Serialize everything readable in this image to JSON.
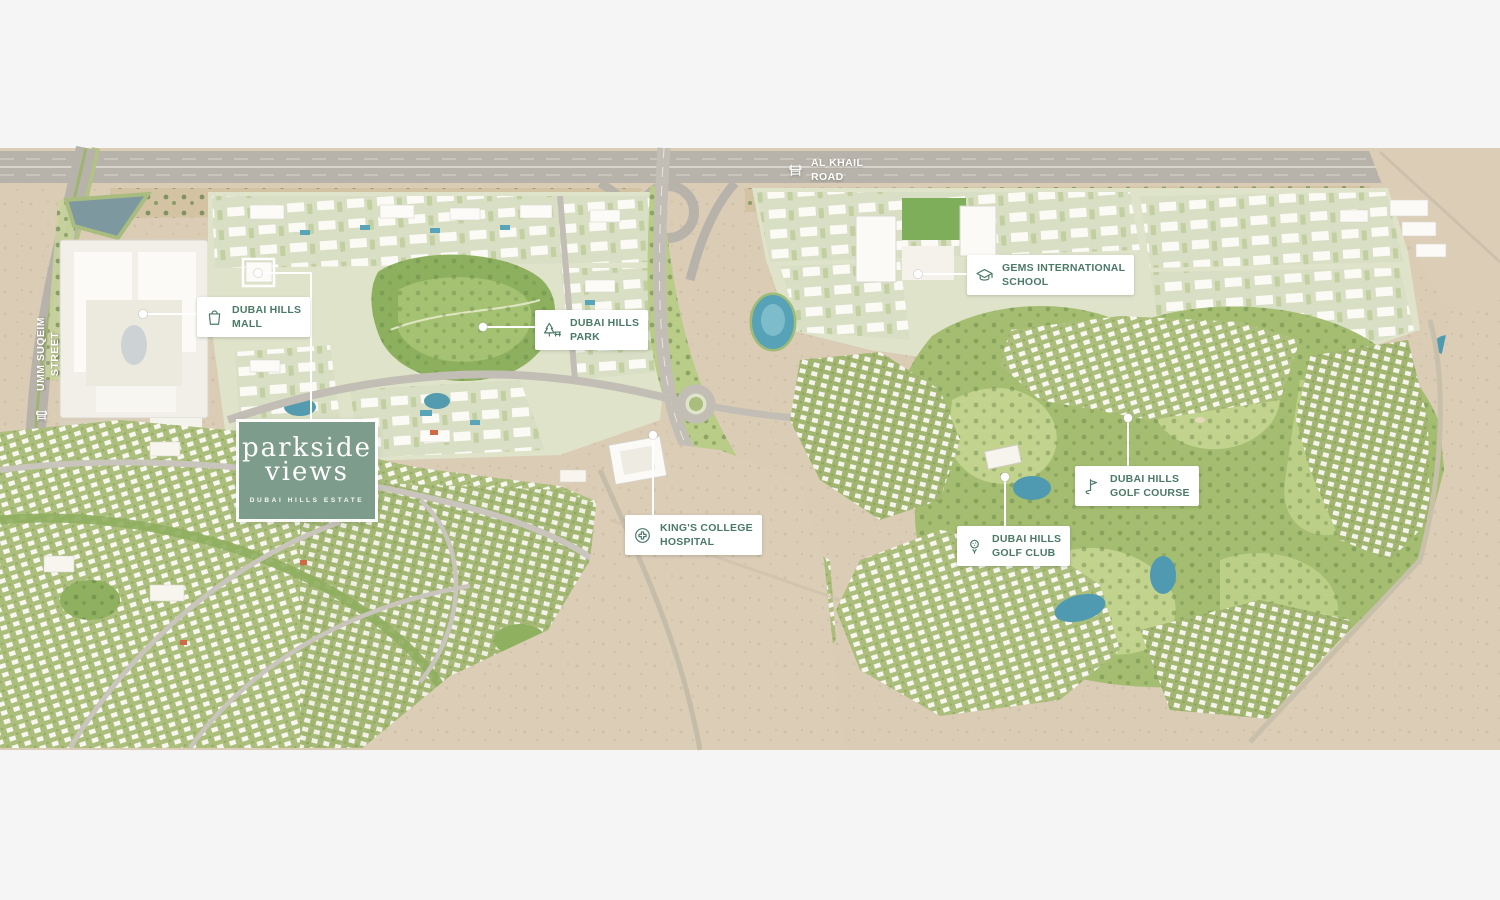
{
  "colors": {
    "page_bg": "#f4f5f4",
    "label_text": "#4c7a67",
    "label_bg": "#ffffff",
    "card_bg": "#7d9c8c",
    "desert": "#daccb5",
    "road": "#b7b3aa",
    "greenery": "#a9bd7d",
    "golf_green": "#a4bd70",
    "water": "#549bb0",
    "white_line": "#ffffff"
  },
  "logo_card": {
    "line1": "parkside",
    "line2": "views",
    "subtitle": "DUBAI HILLS ESTATE"
  },
  "poi_labels": {
    "mall": {
      "line1": "DUBAI HILLS",
      "line2": "MALL",
      "icon": "shopping-bag-icon"
    },
    "park": {
      "line1": "DUBAI HILLS",
      "line2": "PARK",
      "icon": "park-tree-icon"
    },
    "school": {
      "line1": "GEMS INTERNATIONAL",
      "line2": "SCHOOL",
      "icon": "graduation-cap-icon"
    },
    "golf_course": {
      "line1": "DUBAI HILLS",
      "line2": "GOLF COURSE",
      "icon": "golf-flag-icon"
    },
    "golf_club": {
      "line1": "DUBAI HILLS",
      "line2": "GOLF CLUB",
      "icon": "golf-ball-icon"
    },
    "hospital": {
      "line1": "KING'S COLLEGE",
      "line2": "HOSPITAL",
      "icon": "medical-cross-icon"
    }
  },
  "road_labels": {
    "al_khail": {
      "line1": "AL KHAIL",
      "line2": "ROAD",
      "icon": "road-sign-icon"
    },
    "umm_suqeim": {
      "line1": "UMM SUQEIM",
      "line2": "STREET",
      "icon": "road-sign-icon"
    }
  }
}
